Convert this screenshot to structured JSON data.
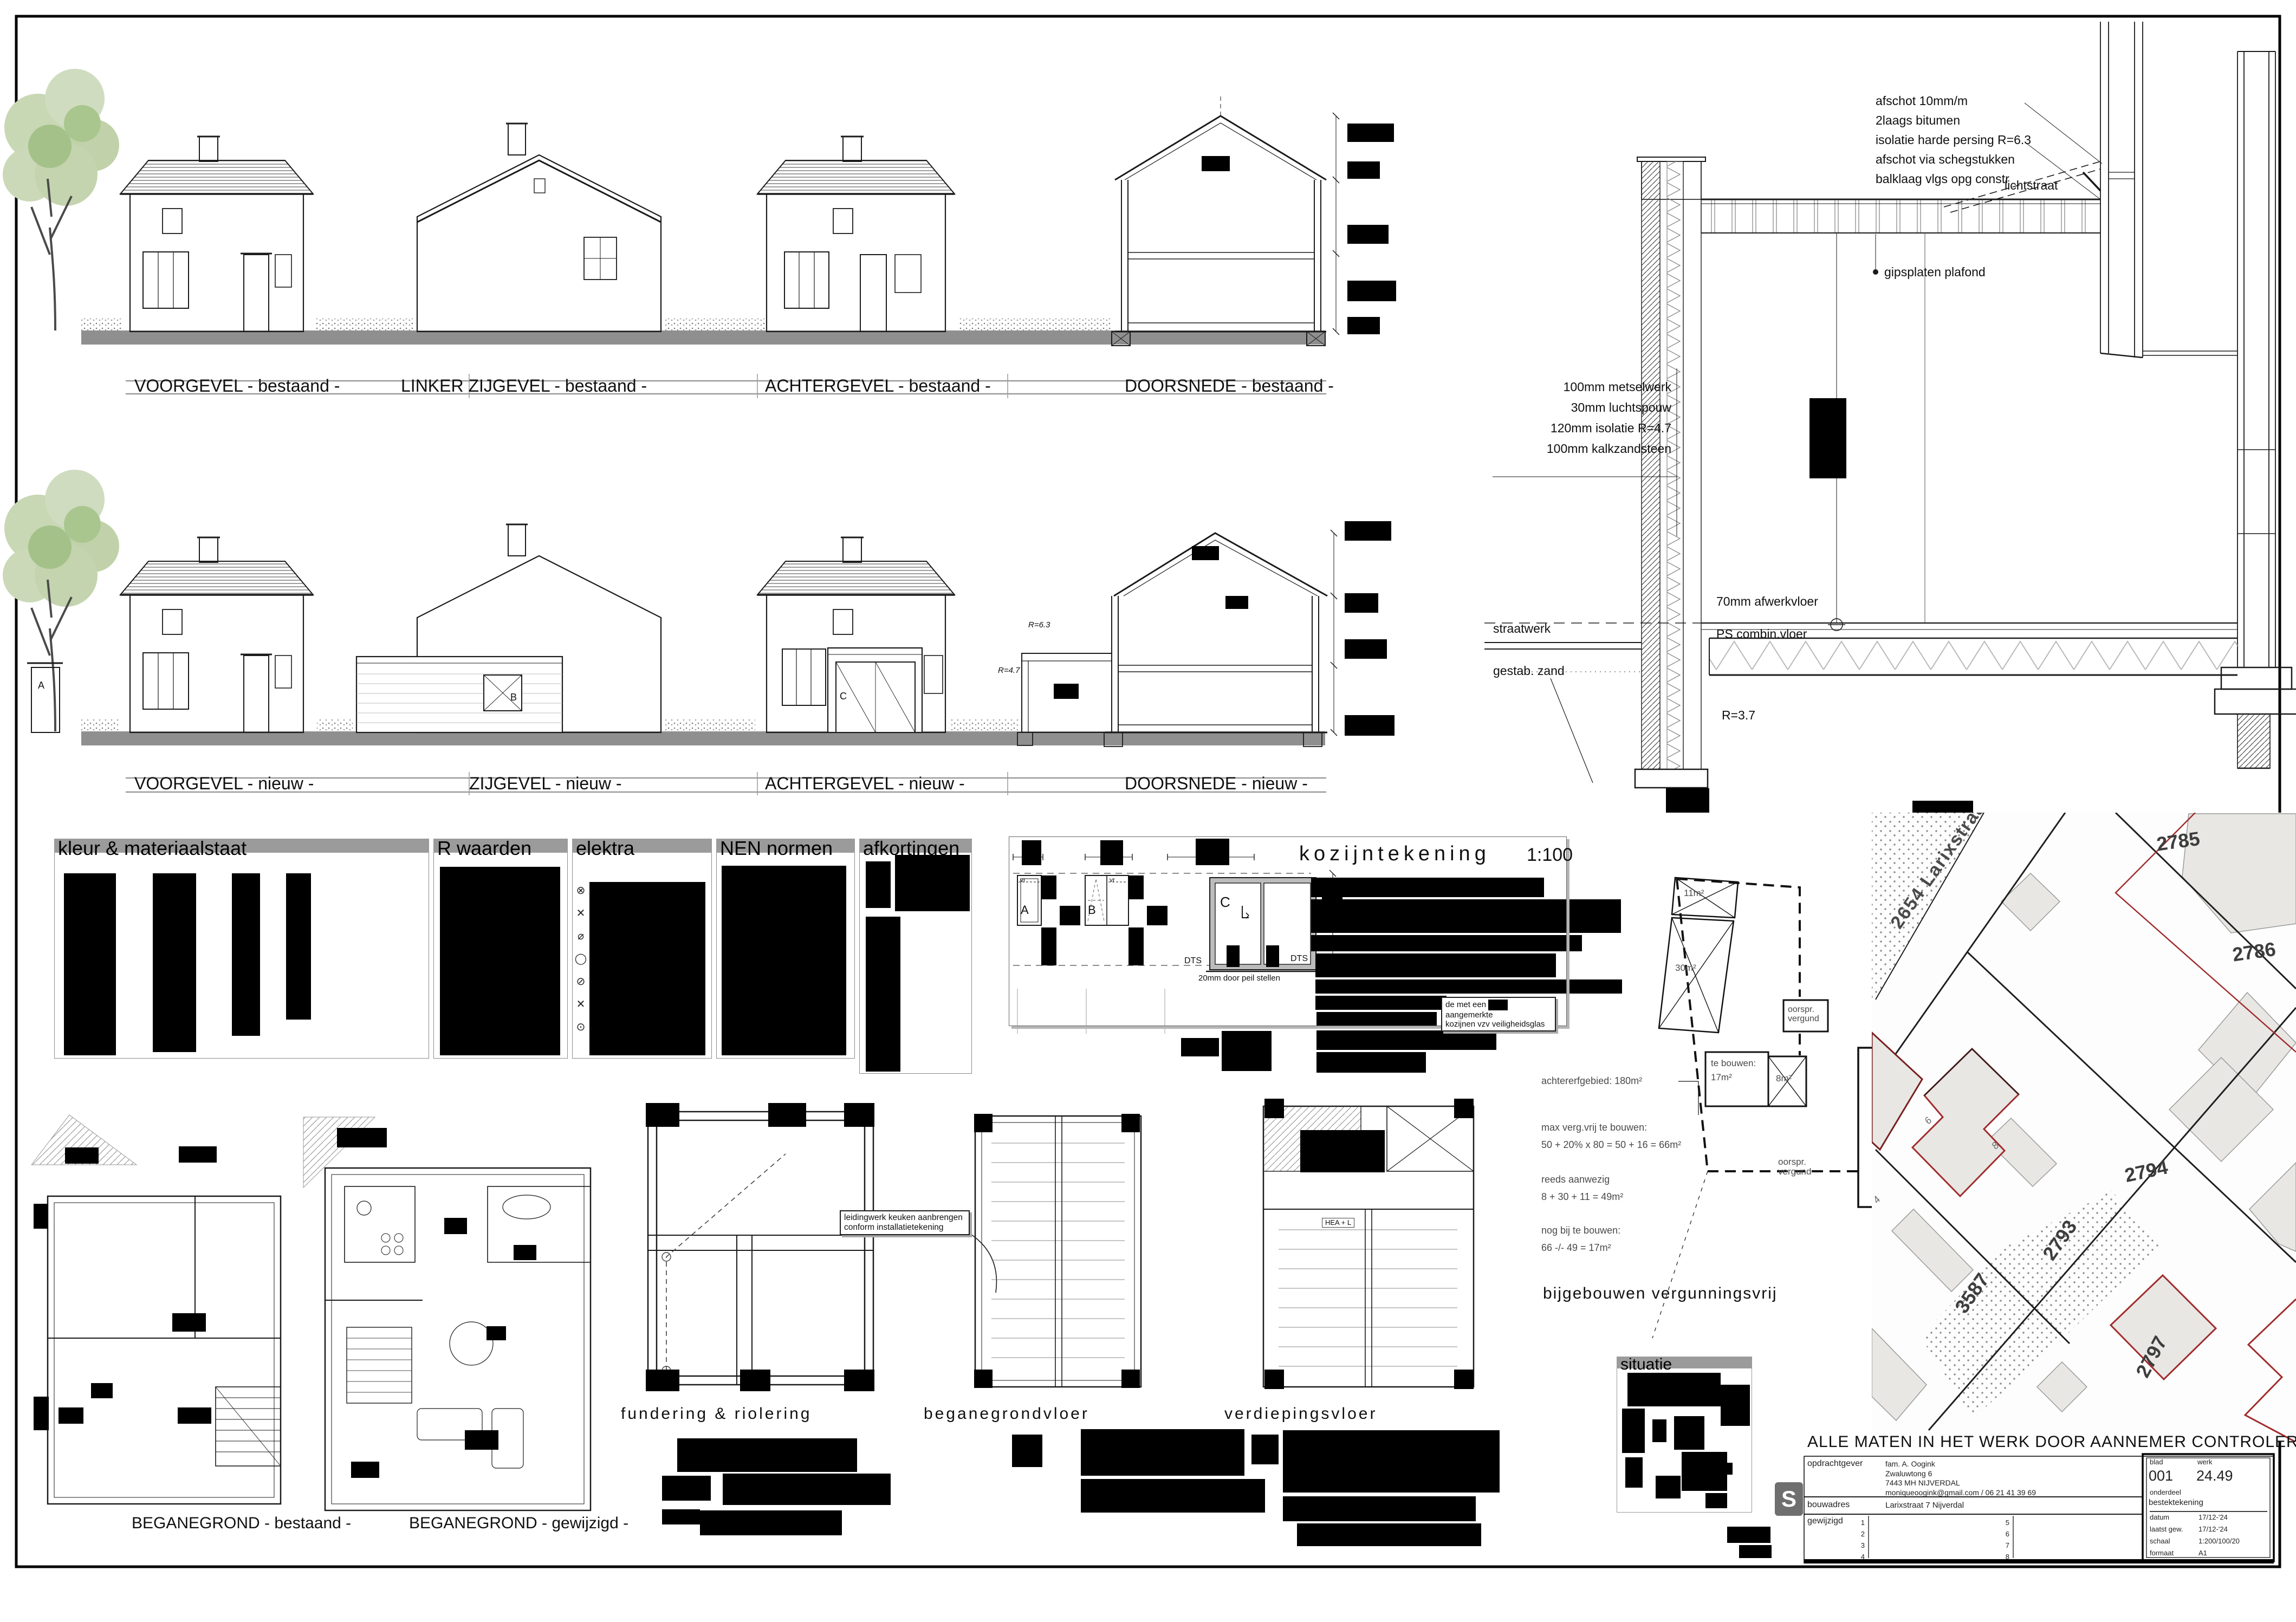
{
  "elevations": {
    "bestaand": [
      "VOORGEVEL - bestaand -",
      "LINKER ZIJGEVEL - bestaand -",
      "ACHTERGEVEL - bestaand -",
      "DOORSNEDE - bestaand -"
    ],
    "nieuw": [
      "VOORGEVEL - nieuw -",
      "ZIJGEVEL - nieuw -",
      "ACHTERGEVEL - nieuw -",
      "DOORSNEDE - nieuw -"
    ],
    "r_roof": "R=6.3",
    "r_wall": "R=4.7"
  },
  "detail": {
    "roof_notes": [
      "afschot 10mm/m",
      "2laags bitumen",
      "isolatie harde persing R=6.3",
      "afschot via schegstukken",
      "balklaag vlgs opg constr"
    ],
    "lichtstraat": "lichtstraat",
    "plafond": "gipsplaten plafond",
    "wall_notes": [
      "100mm metselwerk",
      "30mm luchtspouw",
      "120mm isolatie R=4.7",
      "100mm kalkzandsteen"
    ],
    "afwerkvloer": "70mm afwerkvloer",
    "combivloer": "PS combin.vloer",
    "r_vloer": "R=3.7",
    "straatwerk": "straatwerk",
    "zand": "gestab. zand"
  },
  "legend": {
    "titles": [
      "kleur & materiaalstaat",
      "R waarden",
      "elektra",
      "NEN normen",
      "afkortingen"
    ],
    "elektra_symbols": [
      "⊗",
      "✕",
      "⌀",
      "◯",
      "⊘",
      "✕",
      "⊙"
    ]
  },
  "kozijn": {
    "title": "kozijntekening",
    "scale": "1:100",
    "letter_a": "A",
    "letter_b": "B",
    "letter_c": "C",
    "vr": "vr",
    "dts": "DTS",
    "peil_note": "20mm door peil stellen",
    "glass_note_1": "de met een",
    "glass_note_2": "aangemerkte",
    "glass_note_3": "kozijnen vzv veiligheidsglas"
  },
  "plans": {
    "bestaand_label": "BEGANEGROND - bestaand -",
    "gewijzigd_label": "BEGANEGROND - gewijzigd -",
    "titles": [
      "fundering & riolering",
      "beganegrondvloer",
      "verdiepingsvloer"
    ],
    "kitchen_note_1": "leidingwerk keuken aanbrengen",
    "kitchen_note_2": "conform installatietekening",
    "hea_note": "HEA + L"
  },
  "bijgebouwen": {
    "heading": "bijgebouwen vergunningsvrij",
    "lines": [
      "achtererfgebied: 180m²",
      "max verg.vrij te bouwen:",
      "50 + 20% x 80 = 50 + 16 = 66m²",
      "reeds aanwezig",
      "8 + 30 + 11 = 49m²",
      "nog bij te bouwen:",
      "66 -/- 49 = 17m²"
    ],
    "area_11": "11m²",
    "area_30": "30m²",
    "area_8": "8m²",
    "te_bouwen_1": "te bouwen:",
    "te_bouwen_2": "17m²",
    "oorspr_1": "oorspr.",
    "oorspr_2": "vergund"
  },
  "situatie": {
    "title": "situatie"
  },
  "map": {
    "street": "2654 Larixstraat",
    "parcels": [
      "2785",
      "2786",
      "2794",
      "2793",
      "3587",
      "3588",
      "2797"
    ],
    "houses": [
      "8",
      "6",
      "4"
    ]
  },
  "footer_note": "ALLE MATEN IN HET WERK DOOR AANNEMER CONTROLEREN",
  "titleblock": {
    "logo": "S",
    "opdrachtgever_label": "opdrachtgever",
    "opdrachtgever": [
      "fam. A. Oogink",
      "Zwa luwtong 6",
      "7443 MH  NIJVERDAL",
      "moniqueoogink@gmail.com / 06 21 41 39 69"
    ],
    "bouwadres_label": "bouwadres",
    "bouwadres": "Larixstraat 7 Nijverdal",
    "gewijzigd_label": "gewijzigd",
    "rev_left": [
      "1",
      "2",
      "3",
      "4"
    ],
    "rev_right": [
      "5",
      "6",
      "7",
      "8"
    ],
    "blad_label": "blad",
    "blad": "001",
    "werk_label": "werk",
    "werk": "24.49",
    "onderdeel_label": "onderdeel",
    "onderdeel": "bestektekening",
    "datum_label": "datum",
    "datum": "17/12-'24",
    "laatst_label": "laatst gew.",
    "laatst": "17/12-'24",
    "schaal_label": "schaal",
    "schaal": "1:200/100/20",
    "formaat_label": "formaat",
    "formaat": "A1"
  }
}
